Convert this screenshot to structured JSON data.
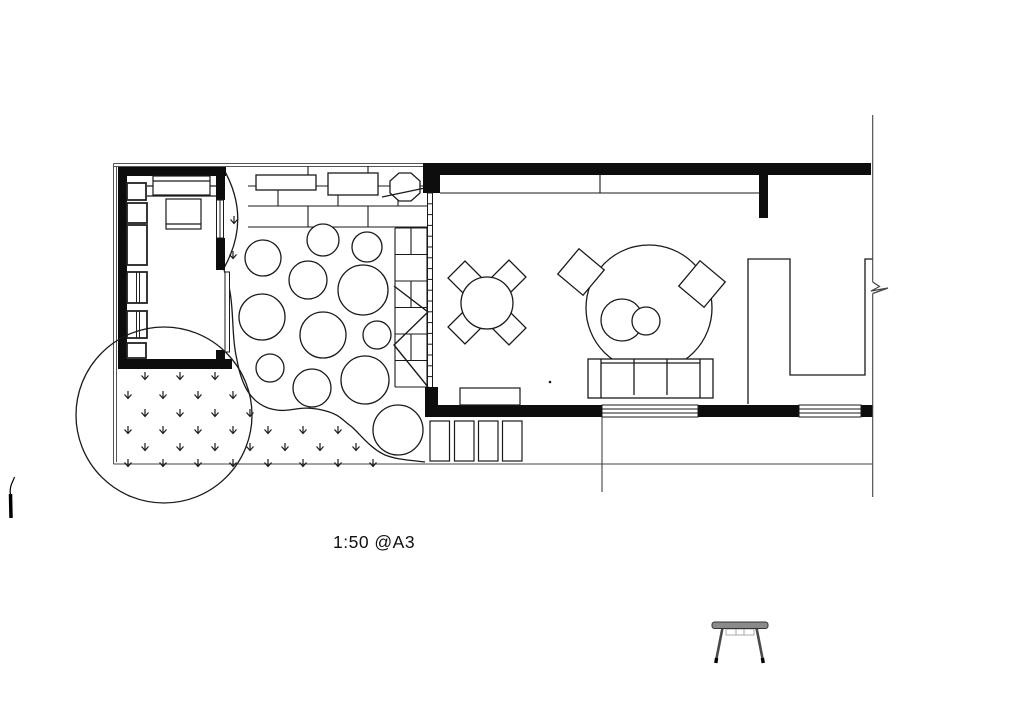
{
  "drawing": {
    "scale_label": "1:50 @A3",
    "colors": {
      "ink": "#1a1a1a",
      "wall_fill": "#0d0d0d",
      "background": "#ffffff",
      "table_top": "#8a8a8a",
      "table_leg": "#4a4a4a",
      "table_foot": "#000000",
      "table_apron": "#aaaaaa"
    }
  },
  "elements": {
    "garden_studio": "garden-studio-room",
    "brick_path": "brick-paved-path",
    "brick_strip": "vertical-brick-edge",
    "stepping_stones": "circular-stepping-stones",
    "lawn": "grass-lawn",
    "tree_canopy": "tree-canopy-circle",
    "main_room": "main-living-room",
    "dining_set": "round-table-four-chairs",
    "lounge_circle": "round-rug-with-chairs",
    "sofa": "three-seat-sofa",
    "u_counter": "u-shaped-unit",
    "break_line": "drawing-break-symbol",
    "table_icon": "small-table-elevation-icon"
  },
  "plan_data": {
    "stepping_stones": [
      [
        263,
        258,
        18
      ],
      [
        323,
        240,
        16
      ],
      [
        367,
        247,
        15
      ],
      [
        308,
        280,
        19
      ],
      [
        363,
        290,
        25
      ],
      [
        262,
        317,
        23
      ],
      [
        323,
        335,
        23
      ],
      [
        377,
        335,
        14
      ],
      [
        270,
        368,
        14
      ],
      [
        312,
        388,
        19
      ],
      [
        365,
        380,
        24
      ],
      [
        398,
        430,
        25
      ]
    ],
    "grass_tufts": [
      [
        234,
        217
      ],
      [
        233,
        252
      ],
      [
        145,
        373
      ],
      [
        180,
        373
      ],
      [
        215,
        373
      ],
      [
        128,
        392
      ],
      [
        163,
        392
      ],
      [
        198,
        392
      ],
      [
        233,
        392
      ],
      [
        145,
        410
      ],
      [
        180,
        410
      ],
      [
        215,
        410
      ],
      [
        250,
        410
      ],
      [
        128,
        427
      ],
      [
        163,
        427
      ],
      [
        198,
        427
      ],
      [
        233,
        427
      ],
      [
        268,
        427
      ],
      [
        303,
        427
      ],
      [
        338,
        427
      ],
      [
        145,
        444
      ],
      [
        180,
        444
      ],
      [
        215,
        444
      ],
      [
        250,
        444
      ],
      [
        285,
        444
      ],
      [
        320,
        444
      ],
      [
        356,
        444
      ],
      [
        128,
        460
      ],
      [
        163,
        460
      ],
      [
        198,
        460
      ],
      [
        233,
        460
      ],
      [
        268,
        460
      ],
      [
        303,
        460
      ],
      [
        338,
        460
      ],
      [
        373,
        460
      ]
    ],
    "tree_canopy": {
      "cx": 164,
      "cy": 415,
      "r": 88
    },
    "brick_path": {
      "x1": 248,
      "x2": 427,
      "rows": [
        166,
        186,
        206,
        227
      ],
      "joints": [
        [
          308,
          368
        ],
        [
          278,
          338,
          398
        ],
        [
          308,
          368
        ]
      ]
    },
    "brick_strip": {
      "x1": 395,
      "x2": 427,
      "y1": 228,
      "y2": 387,
      "row_count": 6,
      "mid_x": 411
    },
    "glazed_wall": {
      "x1": 427.5,
      "x2": 432.5,
      "y1": 193,
      "y2": 387,
      "rung_spacing": 10.8
    },
    "dining_chairs": [
      [
        465,
        278
      ],
      [
        509,
        277
      ],
      [
        465,
        327
      ],
      [
        509,
        328
      ]
    ],
    "lounge_chairs": [
      [
        581,
        272,
        40
      ],
      [
        702,
        284,
        -50
      ]
    ]
  }
}
